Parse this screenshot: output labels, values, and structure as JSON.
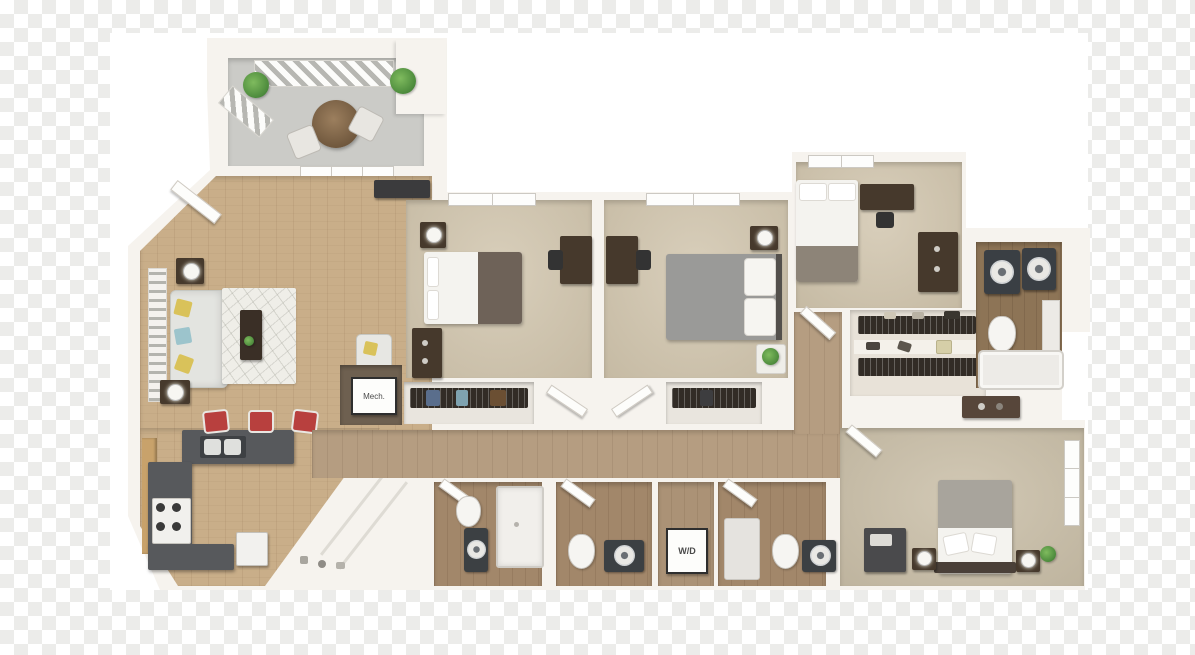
{
  "image": {
    "kind": "3d-floor-plan-render",
    "description": "Top-down 3D rendering of a multi-bedroom apartment floor plan shown over a transparency checkerboard"
  },
  "labels": {
    "mech": "Mech.",
    "washer_dryer": "W/D"
  },
  "rooms": [
    "balcony",
    "living-room",
    "kitchen",
    "corner-pantry",
    "mechanical-closet",
    "bedroom-1",
    "bedroom-2",
    "bedroom-3",
    "bedroom-4",
    "walk-in-closet",
    "bathroom-1",
    "bathroom-2",
    "bathroom-3",
    "bathroom-4",
    "laundry-closet",
    "hallway"
  ],
  "colors": {
    "checker_light": "#ffffff",
    "checker_dark": "#ececea",
    "plate": "#ffffff",
    "wall": "#f6f3ee",
    "wood_floor": "#c9ae89",
    "hall_floor": "#b59d81",
    "carpet": "#d0c4ac",
    "balcony_floor": "#cbcbc7",
    "bath_floor": "#8d7456",
    "counter": "#55585b",
    "stool_red": "#b8403e",
    "furniture_dark": "#46392c",
    "blanket_gray": "#9a9a98",
    "blanket_brown": "#6e6258",
    "plant_green": "#5d9e4c",
    "rug": "#efeee8"
  }
}
